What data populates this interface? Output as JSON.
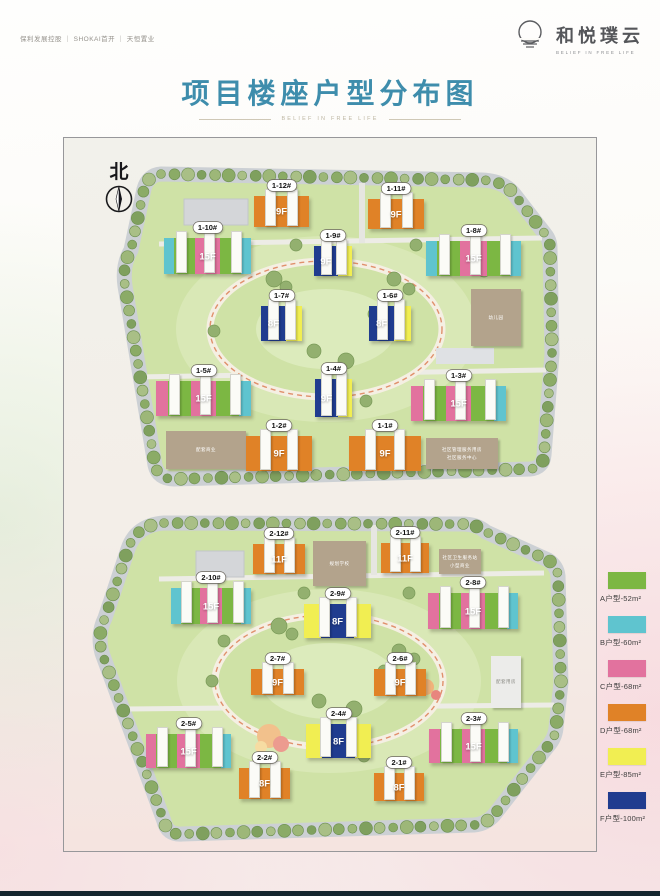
{
  "header": {
    "partners": "保利发展控股 ｜ SHOKAI首开 ｜ 天恒置业",
    "brand": {
      "name": "和悦璞云",
      "tagline": "BELIEF IN FREE LIFE"
    }
  },
  "title": {
    "text": "项目楼座户型分布图",
    "deco": "BELIEF IN FREE LIFE"
  },
  "north": {
    "label": "北"
  },
  "palette": {
    "A": "#7cb743",
    "B": "#5fc4cf",
    "C": "#e2729e",
    "D": "#e08227",
    "E": "#f1ee52",
    "F": "#203c8f",
    "tan": "#b3a38c",
    "gray": "#ececea"
  },
  "legend": {
    "items": [
      {
        "label": "A户型-52m²",
        "color": "#7cb743"
      },
      {
        "label": "B户型-60m²",
        "color": "#5fc4cf"
      },
      {
        "label": "C户型-68m²",
        "color": "#e2729e"
      },
      {
        "label": "D户型-68m²",
        "color": "#e08227"
      },
      {
        "label": "E户型-85m²",
        "color": "#f1ee52"
      },
      {
        "label": "F户型-100m²",
        "color": "#203c8f"
      }
    ]
  },
  "plans": [
    {
      "id": 1,
      "buildings": [
        {
          "id": "1-12#",
          "floors": "9F",
          "x": 190,
          "y": 47,
          "w": 55,
          "h": 31,
          "seg": [
            {
              "c": "D",
              "r": 1,
              "main": true
            }
          ]
        },
        {
          "id": "1-11#",
          "floors": "9F",
          "x": 304,
          "y": 50,
          "w": 56,
          "h": 30,
          "seg": [
            {
              "c": "D",
              "r": 1,
              "main": true
            }
          ]
        },
        {
          "id": "1-10#",
          "floors": "15F",
          "x": 100,
          "y": 89,
          "w": 87,
          "h": 36,
          "seg": [
            {
              "c": "B",
              "r": 1
            },
            {
              "c": "A",
              "r": 2
            },
            {
              "c": "C",
              "r": 2.3,
              "main": true
            },
            {
              "c": "A",
              "r": 2
            },
            {
              "c": "B",
              "r": 1
            }
          ]
        },
        {
          "id": "1-9#",
          "floors": "9F",
          "x": 250,
          "y": 97,
          "w": 38,
          "h": 30,
          "seg": [
            {
              "c": "F",
              "r": 2,
              "main": true
            },
            {
              "c": "E",
              "r": 1.2
            }
          ]
        },
        {
          "id": "1-8#",
          "floors": "15F",
          "x": 362,
          "y": 92,
          "w": 95,
          "h": 35,
          "seg": [
            {
              "c": "B",
              "r": 1
            },
            {
              "c": "A",
              "r": 2
            },
            {
              "c": "C",
              "r": 2.3,
              "main": true
            },
            {
              "c": "A",
              "r": 2
            },
            {
              "c": "B",
              "r": 1
            }
          ]
        },
        {
          "id": "1-7#",
          "floors": "8F",
          "x": 197,
          "y": 157,
          "w": 41,
          "h": 35,
          "seg": [
            {
              "c": "F",
              "r": 2,
              "main": true
            },
            {
              "c": "E",
              "r": 1.3
            }
          ]
        },
        {
          "id": "1-6#",
          "floors": "8F",
          "x": 305,
          "y": 157,
          "w": 42,
          "h": 35,
          "seg": [
            {
              "c": "F",
              "r": 2,
              "main": true
            },
            {
              "c": "E",
              "r": 1.3
            }
          ]
        },
        {
          "id": "1-5#",
          "floors": "15F",
          "x": 92,
          "y": 232,
          "w": 95,
          "h": 35,
          "seg": [
            {
              "c": "C",
              "r": 1
            },
            {
              "c": "A",
              "r": 2
            },
            {
              "c": "C",
              "r": 2.2,
              "main": true
            },
            {
              "c": "A",
              "r": 2
            },
            {
              "c": "B",
              "r": 1
            }
          ]
        },
        {
          "id": "1-4#",
          "floors": "9F",
          "x": 251,
          "y": 230,
          "w": 37,
          "h": 38,
          "seg": [
            {
              "c": "F",
              "r": 1.6,
              "main": true
            },
            {
              "c": "E",
              "r": 1
            }
          ]
        },
        {
          "id": "1-3#",
          "floors": "15F",
          "x": 347,
          "y": 237,
          "w": 95,
          "h": 35,
          "seg": [
            {
              "c": "C",
              "r": 1
            },
            {
              "c": "A",
              "r": 2
            },
            {
              "c": "C",
              "r": 2.2,
              "main": true
            },
            {
              "c": "A",
              "r": 2
            },
            {
              "c": "B",
              "r": 1
            }
          ]
        },
        {
          "id": "1-2#",
          "floors": "9F",
          "x": 182,
          "y": 287,
          "w": 66,
          "h": 35,
          "seg": [
            {
              "c": "D",
              "r": 1,
              "main": true
            }
          ]
        },
        {
          "id": "1-1#",
          "floors": "9F",
          "x": 285,
          "y": 287,
          "w": 72,
          "h": 35,
          "seg": [
            {
              "c": "D",
              "r": 1,
              "main": true
            }
          ]
        }
      ],
      "facilities": [
        {
          "name": "配套商业",
          "x": 102,
          "y": 282,
          "w": 80,
          "h": 38
        },
        {
          "name": "社区管理服务用房\n社区服务中心",
          "x": 362,
          "y": 289,
          "w": 72,
          "h": 31
        },
        {
          "name": "幼儿园",
          "x": 407,
          "y": 140,
          "w": 50,
          "h": 57
        }
      ]
    },
    {
      "id": 2,
      "buildings": [
        {
          "id": "2-12#",
          "floors": "11F",
          "x": 189,
          "y": 43,
          "w": 52,
          "h": 30,
          "seg": [
            {
              "c": "D",
              "r": 1,
              "main": true
            }
          ]
        },
        {
          "id": "2-11#",
          "floors": "11F",
          "x": 317,
          "y": 42,
          "w": 48,
          "h": 30,
          "seg": [
            {
              "c": "D",
              "r": 1,
              "main": true
            }
          ]
        },
        {
          "id": "2-10#",
          "floors": "15F",
          "x": 107,
          "y": 87,
          "w": 80,
          "h": 36,
          "seg": [
            {
              "c": "B",
              "r": 1
            },
            {
              "c": "A",
              "r": 2
            },
            {
              "c": "C",
              "r": 2.3,
              "main": true
            },
            {
              "c": "A",
              "r": 2
            },
            {
              "c": "B",
              "r": 1
            }
          ]
        },
        {
          "id": "2-9#",
          "floors": "8F",
          "x": 240,
          "y": 103,
          "w": 67,
          "h": 34,
          "seg": [
            {
              "c": "E",
              "r": 1
            },
            {
              "c": "F",
              "r": 2,
              "main": true
            },
            {
              "c": "E",
              "r": 1
            }
          ]
        },
        {
          "id": "2-8#",
          "floors": "15F",
          "x": 364,
          "y": 92,
          "w": 90,
          "h": 36,
          "seg": [
            {
              "c": "C",
              "r": 1
            },
            {
              "c": "A",
              "r": 2
            },
            {
              "c": "C",
              "r": 2.2,
              "main": true
            },
            {
              "c": "A",
              "r": 2
            },
            {
              "c": "B",
              "r": 1
            }
          ]
        },
        {
          "id": "2-7#",
          "floors": "9F",
          "x": 187,
          "y": 168,
          "w": 53,
          "h": 26,
          "seg": [
            {
              "c": "D",
              "r": 1,
              "main": true
            }
          ]
        },
        {
          "id": "2-6#",
          "floors": "9F",
          "x": 310,
          "y": 168,
          "w": 52,
          "h": 27,
          "seg": [
            {
              "c": "D",
              "r": 1,
              "main": true
            }
          ]
        },
        {
          "id": "2-4#",
          "floors": "8F",
          "x": 242,
          "y": 223,
          "w": 65,
          "h": 34,
          "seg": [
            {
              "c": "E",
              "r": 1
            },
            {
              "c": "F",
              "r": 2,
              "main": true
            },
            {
              "c": "E",
              "r": 1
            }
          ]
        },
        {
          "id": "2-5#",
          "floors": "15F",
          "x": 82,
          "y": 233,
          "w": 85,
          "h": 34,
          "seg": [
            {
              "c": "C",
              "r": 1
            },
            {
              "c": "A",
              "r": 2
            },
            {
              "c": "C",
              "r": 2.2,
              "main": true
            },
            {
              "c": "A",
              "r": 2
            },
            {
              "c": "B",
              "r": 1
            }
          ]
        },
        {
          "id": "2-3#",
          "floors": "15F",
          "x": 365,
          "y": 228,
          "w": 89,
          "h": 34,
          "seg": [
            {
              "c": "C",
              "r": 1
            },
            {
              "c": "A",
              "r": 2
            },
            {
              "c": "C",
              "r": 2.2,
              "main": true
            },
            {
              "c": "A",
              "r": 2
            },
            {
              "c": "B",
              "r": 1
            }
          ]
        },
        {
          "id": "2-2#",
          "floors": "8F",
          "x": 175,
          "y": 267,
          "w": 51,
          "h": 31,
          "seg": [
            {
              "c": "D",
              "r": 1,
              "main": true
            }
          ]
        },
        {
          "id": "2-1#",
          "floors": "8F",
          "x": 310,
          "y": 272,
          "w": 50,
          "h": 28,
          "seg": [
            {
              "c": "D",
              "r": 1,
              "main": true
            }
          ]
        }
      ],
      "facilities": [
        {
          "name": "规划学校",
          "x": 249,
          "y": 40,
          "w": 53,
          "h": 45
        },
        {
          "name": "社区卫生服务站\n小型商业",
          "x": 375,
          "y": 48,
          "w": 42,
          "h": 25
        },
        {
          "name": "配套用房",
          "x": 427,
          "y": 155,
          "w": 30,
          "h": 52,
          "color": "#ececea",
          "dark": true
        }
      ]
    }
  ]
}
